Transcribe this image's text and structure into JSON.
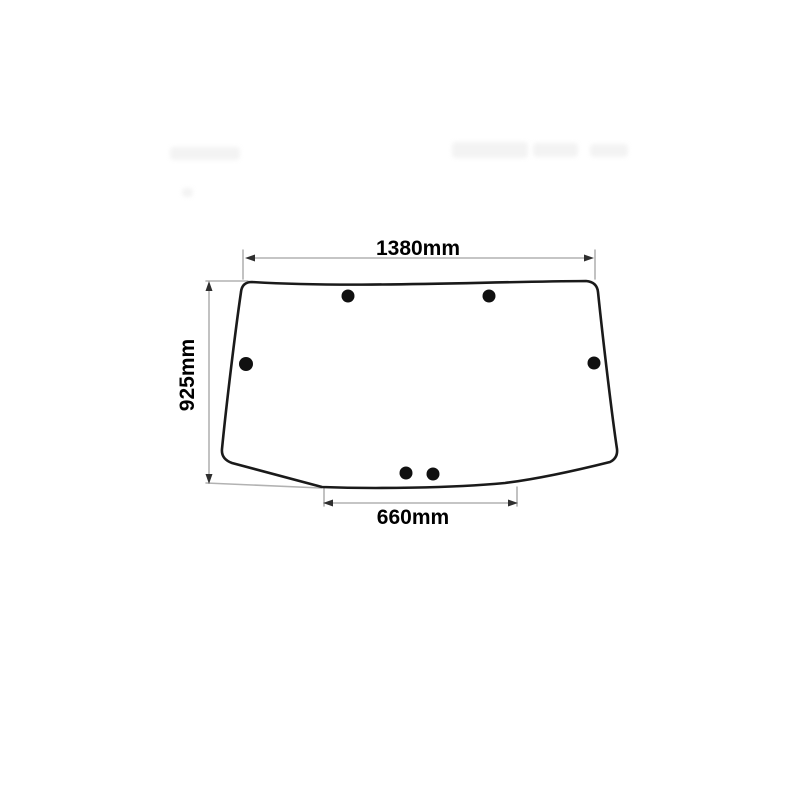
{
  "page": {
    "background": "#ffffff"
  },
  "diagram": {
    "type": "technical-drawing",
    "subject": "glass panel outline with six mounting holes and dimension callouts",
    "labels": {
      "top_width": "1380mm",
      "left_height": "925mm",
      "bottom_width": "660mm"
    },
    "holes": {
      "count": 6,
      "top": 2,
      "left": 1,
      "right": 1,
      "bottom": 2
    },
    "colors": {
      "outline": "#1a1a1a",
      "dimension_line": "#b2b2b2",
      "arrowhead": "#2f2f2f",
      "label_text": "#000000",
      "hole_fill": "#101010",
      "watermark": "#f1f1f1"
    }
  }
}
